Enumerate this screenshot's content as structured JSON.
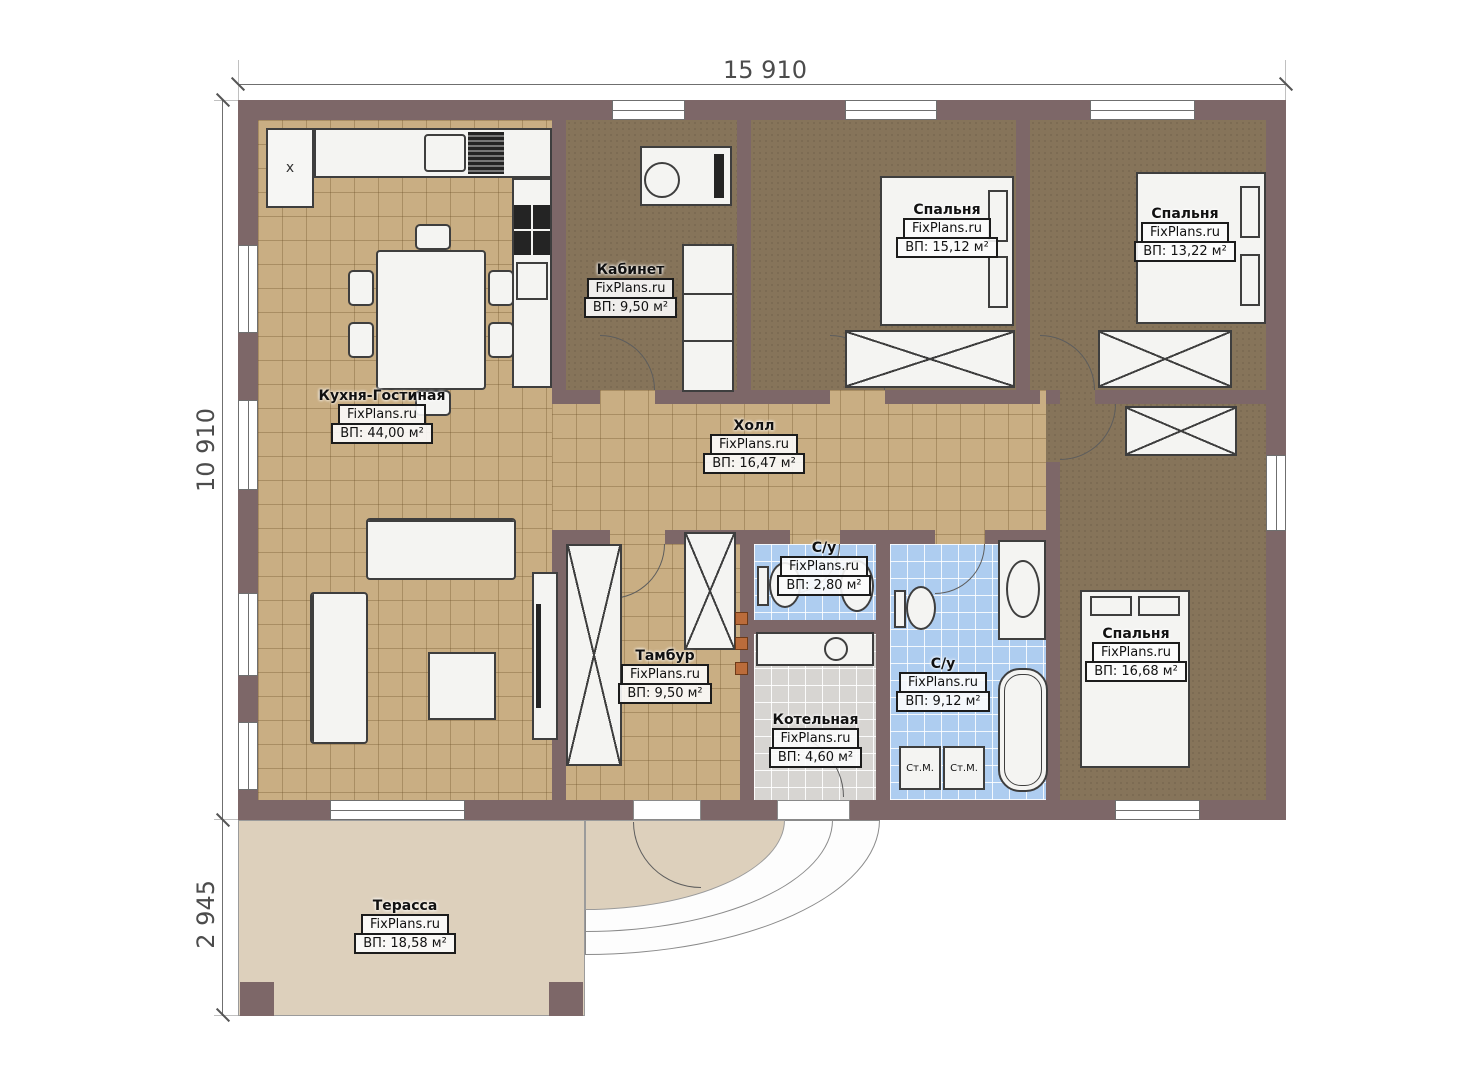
{
  "dims": {
    "width_total": "15 910",
    "height_total": "10 910",
    "terrace_depth": "2 945"
  },
  "labels": {
    "washer": "Ст.М.",
    "corner_mark": "x"
  },
  "rooms": [
    {
      "key": "kitchen-living",
      "name": "Кухня-Гостиная",
      "site": "FixPlans.ru",
      "area": "ВП: 44,00 м²"
    },
    {
      "key": "office",
      "name": "Кабинет",
      "site": "FixPlans.ru",
      "area": "ВП: 9,50 м²"
    },
    {
      "key": "bedroom-1",
      "name": "Спальня",
      "site": "FixPlans.ru",
      "area": "ВП: 15,12 м²"
    },
    {
      "key": "bedroom-2",
      "name": "Спальня",
      "site": "FixPlans.ru",
      "area": "ВП: 13,22 м²"
    },
    {
      "key": "hall",
      "name": "Холл",
      "site": "FixPlans.ru",
      "area": "ВП: 16,47 м²"
    },
    {
      "key": "bathroom-small",
      "name": "С/у",
      "site": "FixPlans.ru",
      "area": "ВП: 2,80 м²"
    },
    {
      "key": "vestibule",
      "name": "Тамбур",
      "site": "FixPlans.ru",
      "area": "ВП: 9,50 м²"
    },
    {
      "key": "boiler-room",
      "name": "Котельная",
      "site": "FixPlans.ru",
      "area": "ВП: 4,60 м²"
    },
    {
      "key": "bathroom-big",
      "name": "С/у",
      "site": "FixPlans.ru",
      "area": "ВП: 9,12 м²"
    },
    {
      "key": "bedroom-3",
      "name": "Спальня",
      "site": "FixPlans.ru",
      "area": "ВП: 16,68 м²"
    },
    {
      "key": "terrace",
      "name": "Терасса",
      "site": "FixPlans.ru",
      "area": "ВП: 18,58 м²"
    }
  ],
  "colors": {
    "wall": "#7d6768",
    "tile_beige": "#c9ae83",
    "carpet": "#86745a",
    "tile_blue": "#aecdf0",
    "tile_gray": "#d7d5d2",
    "terrace": "#ddd0bc"
  }
}
